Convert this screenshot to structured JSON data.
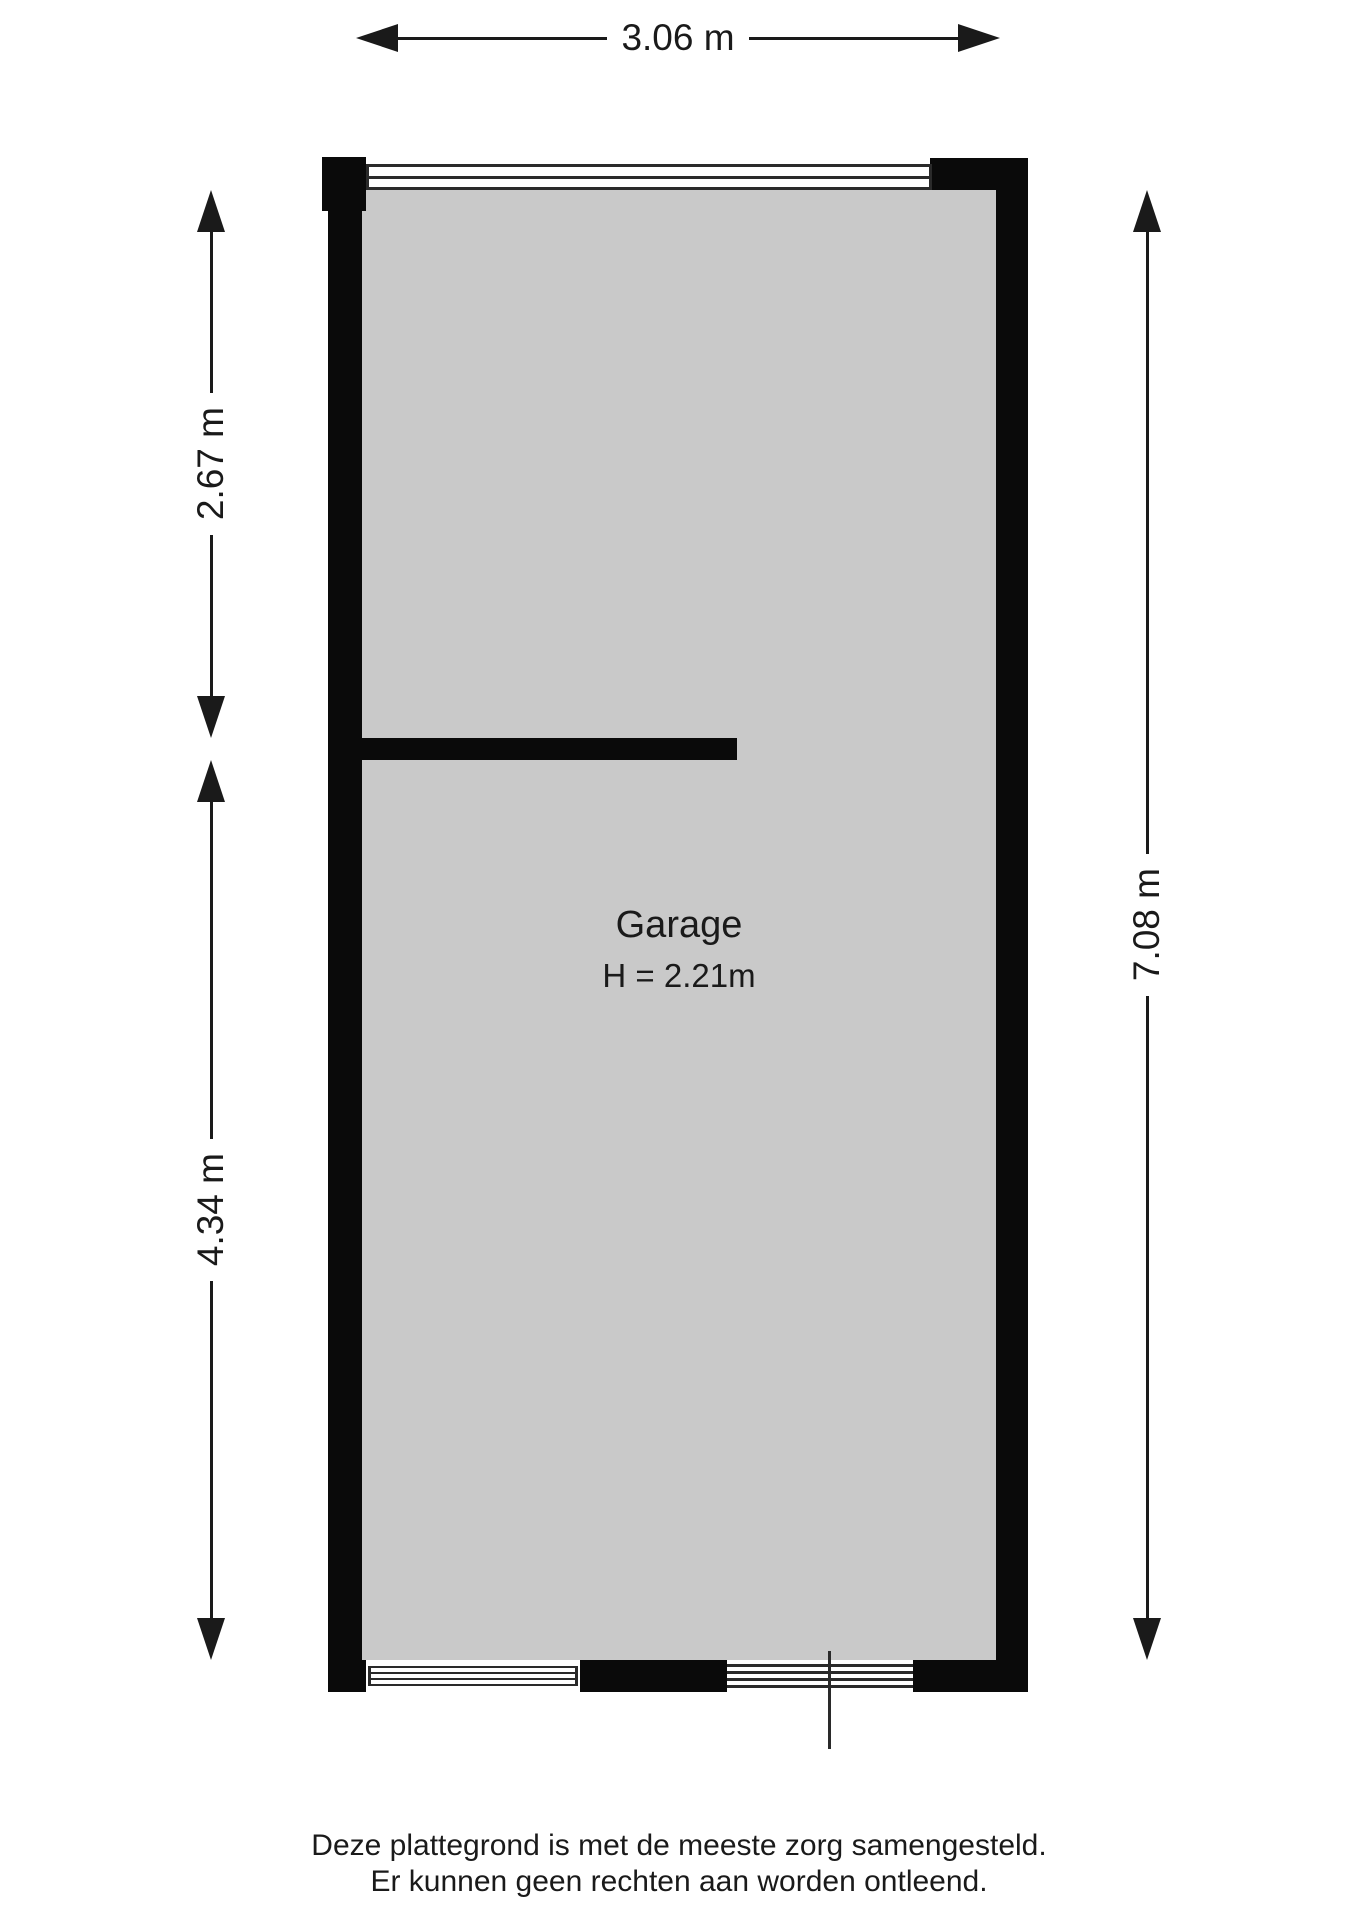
{
  "dimensions": {
    "top": "3.06 m",
    "left_upper": "2.67 m",
    "left_lower": "4.34 m",
    "right": "7.08 m"
  },
  "room": {
    "name": "Garage",
    "height": "H = 2.21m"
  },
  "disclaimer": {
    "line1": "Deze plattegrond is met de meeste zorg samengesteld.",
    "line2": "Er kunnen geen rechten aan worden ontleend."
  },
  "colors": {
    "wall": "#0a0a0a",
    "floor": "#c9c9c9",
    "window_line": "#2a2a2a",
    "text": "#1a1a1a",
    "background": "#ffffff"
  }
}
